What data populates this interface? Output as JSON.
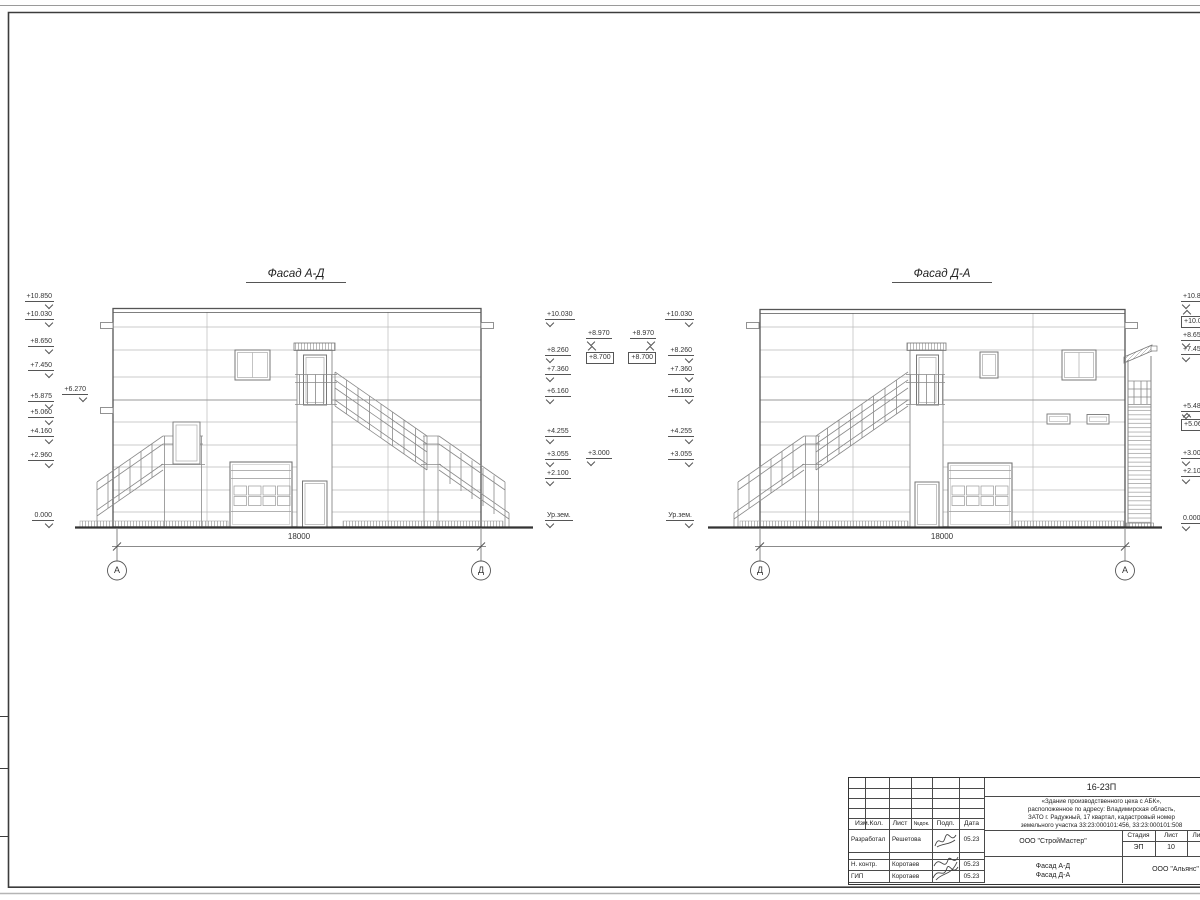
{
  "drawing": {
    "facades": [
      {
        "title": "Фасад А-Д",
        "dimension": "18000",
        "axis_left": "А",
        "axis_right": "Д"
      },
      {
        "title": "Фасад Д-А",
        "dimension": "18000",
        "axis_left": "Д",
        "axis_right": "А"
      }
    ],
    "elevation_marks": {
      "left_outer": [
        "+10.850",
        "+10.030",
        "+8.650",
        "+7.450",
        "+5.875",
        "+5.060",
        "+4.160",
        "+2.960",
        "0.000"
      ],
      "left_inner": "+6.270",
      "left_right_col": [
        "+10.030",
        "+8.260",
        "+7.360",
        "+6.160",
        "+4.255",
        "+3.055",
        "+2.100",
        "Ур.зем."
      ],
      "mid_left_pair": [
        "+8.970",
        "+8.700"
      ],
      "mid_extra": "+3.000",
      "mid_right_pair": [
        "+8.970",
        "+8.700"
      ],
      "right_left_col": [
        "+10.030",
        "+8.260",
        "+7.360",
        "+6.160",
        "+4.255",
        "+3.055",
        "Ур.зем."
      ],
      "right_outer": [
        "+10.850",
        "+10.030",
        "+8.650",
        "+7.450",
        "+5.485",
        "+5.060",
        "+3.000",
        "+2.100",
        "0.000"
      ]
    }
  },
  "titleblock": {
    "code": "16-23П",
    "description_lines": [
      "«Здание производственного цеха с АБК»,",
      "расположенное по адресу: Владимирская область,",
      "ЗАТО г. Радужный, 17 квартал, кадастровый номер",
      "земельного участка 33:23:000101:456, 33:23:000101:508"
    ],
    "columns": [
      "Изм.Кол.",
      "Лист",
      "№док.",
      "Подп.",
      "Дата"
    ],
    "rows": [
      {
        "role": "Разработал",
        "name": "Решетова",
        "date": "05.23"
      },
      {
        "role": "Н. контр.",
        "name": "Коротаев",
        "date": "05.23"
      },
      {
        "role": "ГИП",
        "name": "Коротаев",
        "date": "05.23"
      }
    ],
    "org": "ООО \"СтройМастер\"",
    "stage_label": "Стадия",
    "sheet_label": "Лист",
    "sheets_label": "Листов",
    "stage": "ЭП",
    "sheet_no": "10",
    "sheets_total": "1",
    "doc_title_lines": [
      "Фасад А-Д",
      "Фасад Д-А"
    ],
    "client": "ООО \"Альянс\""
  }
}
